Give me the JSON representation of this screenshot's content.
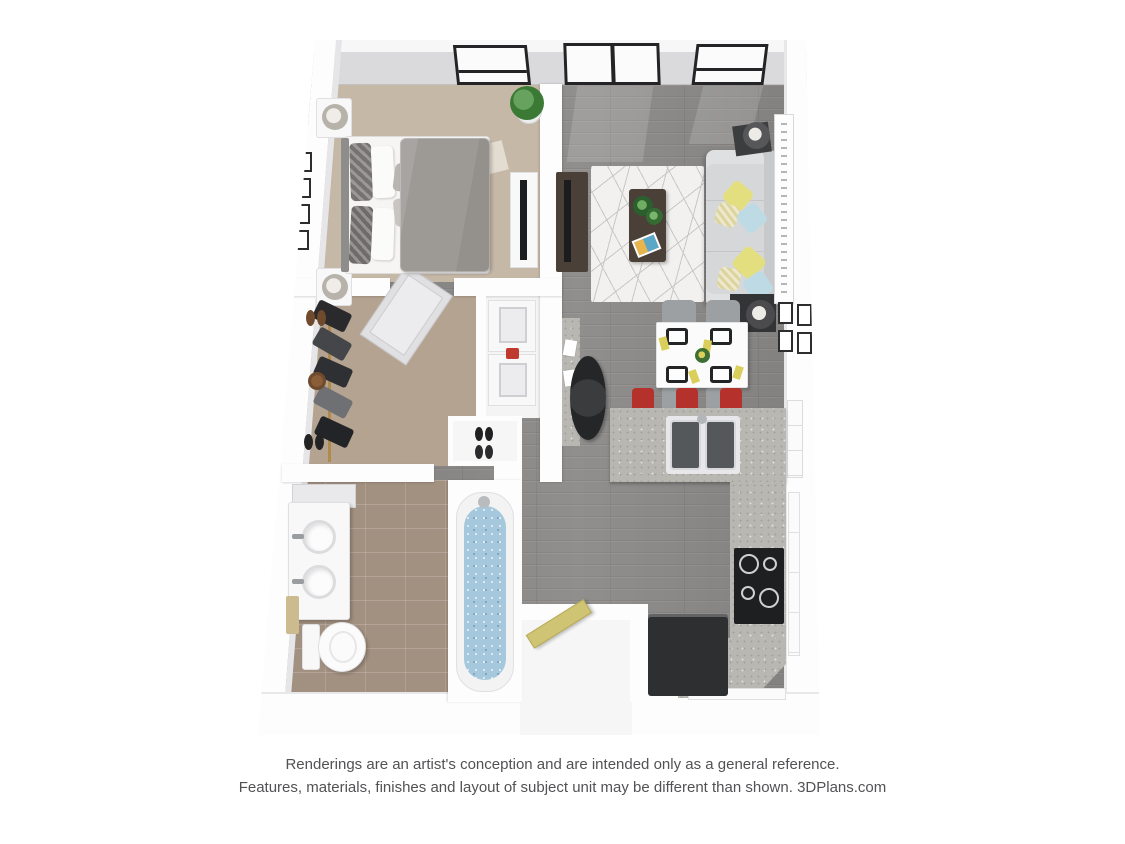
{
  "page": {
    "background": "#ffffff",
    "kind": "3d-floor-plan-rendering"
  },
  "footer": {
    "line1": "Renderings are an artist's conception and are intended only as a general reference.",
    "line2": "Features, materials, finishes and layout of subject unit may be different than shown. 3DPlans.com"
  },
  "colors": {
    "wall": "#fdfdfe",
    "wall_face": "#dadadc",
    "carpet_bedroom": "#c6b8a7",
    "carpet_closet": "#b4a390",
    "tile": "#a29080",
    "wood": "#8b8987",
    "rug": "#f2f1ef",
    "rug_line": "#c9c7c3",
    "sofa": "#d6d7d8",
    "pillow_yellow": "#e4df7e",
    "pillow_blue": "#bedbe5",
    "wood_dark": "#4a4038",
    "granite": "#b9b7b2",
    "granite_speck": "#a3a19c",
    "stool": "#b5322c",
    "appliance_black": "#1e1f21",
    "fridge": "#2d2f31",
    "white_fixture": "#f8f8f9",
    "water": "#a5c8dc",
    "door_yellow": "#cfc473",
    "frame": "#2d2d2f",
    "glass": "#fbfbfc",
    "window_frame": "#242426",
    "chair": "#9ca0a2",
    "text": "#525255"
  },
  "plan": {
    "rooms": [
      {
        "name": "bedroom",
        "floor": "beige carpet",
        "furniture": [
          "queen-bed",
          "headboard",
          "nightstand x2",
          "table-lamp x2",
          "wall-frames x4",
          "dresser",
          "tv",
          "potted-plant",
          "window"
        ]
      },
      {
        "name": "living-room",
        "floor": "gray wood",
        "furniture": [
          "sofa",
          "throw-pillows yellow/blue",
          "area-rug",
          "coffee-table",
          "plants",
          "media-console",
          "tv",
          "floor-lamp x2",
          "art-canvas",
          "sliding-door",
          "window"
        ]
      },
      {
        "name": "dining-area",
        "floor": "gray wood",
        "furniture": [
          "dining-table",
          "chairs x4",
          "placemats x4",
          "napkins yellow",
          "centerpiece",
          "wall-frames x4"
        ]
      },
      {
        "name": "kitchen",
        "floor": "gray wood",
        "furniture": [
          "island",
          "bar-stools-red x3",
          "double-sink",
          "cooktop",
          "refrigerator",
          "cabinets"
        ]
      },
      {
        "name": "walk-in-closet",
        "floor": "beige carpet",
        "furniture": [
          "shoe-shelf",
          "hanging-clothes",
          "closet-door",
          "washer",
          "dryer",
          "shoe-cubby"
        ]
      },
      {
        "name": "bathroom",
        "floor": "tan tile",
        "furniture": [
          "vanity-double-sink",
          "mirror-cabinet",
          "toilet",
          "towel",
          "bathtub"
        ]
      },
      {
        "name": "entry",
        "floor": "white",
        "furniture": [
          "entry-door-yellow",
          "desk",
          "office-chair"
        ]
      }
    ]
  }
}
